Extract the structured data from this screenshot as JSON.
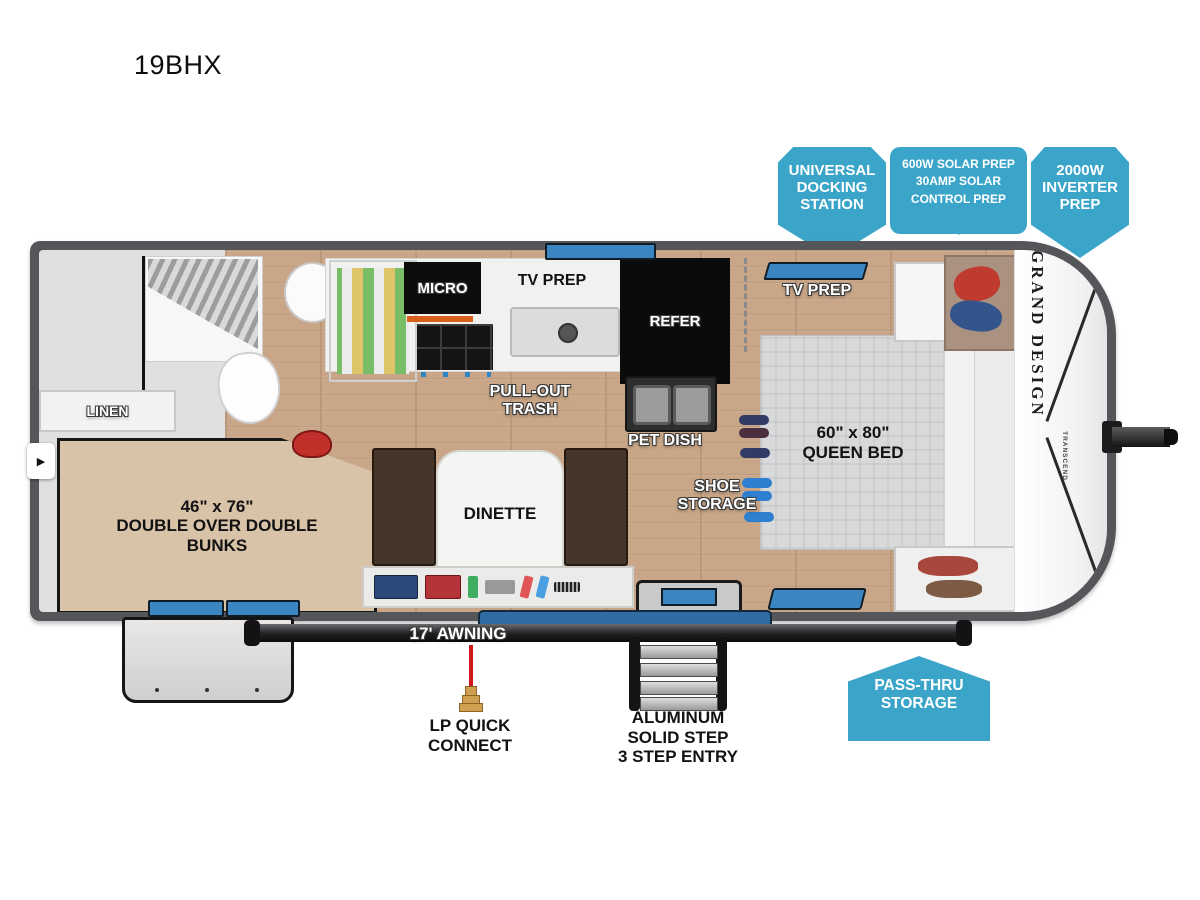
{
  "title": "19BHX",
  "colors": {
    "callout_blue": "#3BA5C9",
    "window_blue": "#3B85C0",
    "wall_gray": "#55565A",
    "wood_floor": "#C9A687",
    "lp_line_red": "#D01818"
  },
  "callouts": {
    "universal_docking": "UNIVERSAL\nDOCKING\nSTATION",
    "solar_prep": "600W SOLAR PREP\n30AMP SOLAR\nCONTROL PREP",
    "inverter_prep": "2000W\nINVERTER\nPREP",
    "pass_thru_storage": "PASS-THRU\nSTORAGE"
  },
  "exterior": {
    "awning": "17' AWNING",
    "lp_quick_connect": "LP QUICK\nCONNECT",
    "entry_steps": "ALUMINUM\nSOLID STEP\n3 STEP ENTRY"
  },
  "interior": {
    "linen": "LINEN",
    "micro": "MICRO",
    "tv_prep_kitchen": "TV PREP",
    "refer": "REFER",
    "pull_out_trash": "PULL-OUT\nTRASH",
    "pet_dish": "PET DISH",
    "tv_prep_bedroom": "TV PREP",
    "queen_bed": "60\" x 80\"\nQUEEN BED",
    "shoe_storage": "SHOE\nSTORAGE",
    "bunks": "46\" x 76\"\nDOUBLE OVER DOUBLE\nBUNKS",
    "dinette": "DINETTE"
  },
  "branding": {
    "manufacturer": "GRAND DESIGN",
    "series": "TRANSCEND"
  }
}
